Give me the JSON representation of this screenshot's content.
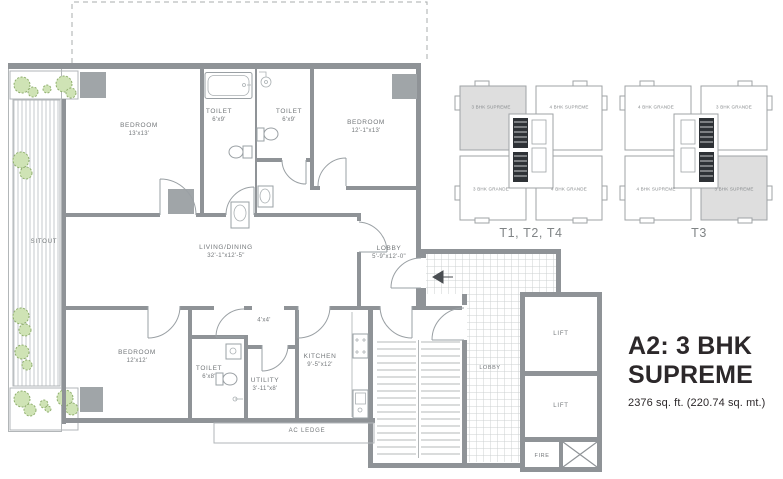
{
  "title": {
    "line1": "A2: 3 BHK",
    "line2": "SUPREME",
    "area": "2376 sq. ft. (220.74 sq. mt.)"
  },
  "plan": {
    "rooms": {
      "bedroom1": {
        "name": "BEDROOM",
        "dims": "13'x13'"
      },
      "toilet1": {
        "name": "TOILET",
        "dims": "6'x9'"
      },
      "toilet2": {
        "name": "TOILET",
        "dims": "6'x9'"
      },
      "bedroom2": {
        "name": "BEDROOM",
        "dims": "12'-1\"x13'"
      },
      "living": {
        "name": "LIVING/DINING",
        "dims": "32'-1\"x12'-5\""
      },
      "lobby": {
        "name": "LOBBY",
        "dims": "5'-9\"x12'-0\""
      },
      "bedroom3": {
        "name": "BEDROOM",
        "dims": "12'x12'"
      },
      "toilet3": {
        "name": "TOILET",
        "dims": "6'x8'"
      },
      "utility": {
        "name": "UTILITY",
        "dims": "3'-11\"x8'"
      },
      "kitchen": {
        "name": "KITCHEN",
        "dims": "9'-5\"x12'"
      },
      "passage": {
        "dims": "4'x4'"
      }
    },
    "areas": {
      "sitout": "SITOUT",
      "ac_ledge": "AC LEDGE",
      "core_lobby": "LOBBY",
      "lift": "LIFT",
      "fire": "FIRE"
    }
  },
  "keyplans": [
    {
      "caption": "T1, T2, T4",
      "units": [
        {
          "label": "3 BHK SUPREME",
          "highlight": true
        },
        {
          "label": "4 BHK SUPREME",
          "highlight": false
        },
        {
          "label": "3 BHK GRANDE",
          "highlight": false
        },
        {
          "label": "4 BHK GRANDE",
          "highlight": false
        }
      ]
    },
    {
      "caption": "T3",
      "units": [
        {
          "label": "4 BHK GRANDE",
          "highlight": false
        },
        {
          "label": "3 BHK GRANDE",
          "highlight": false
        },
        {
          "label": "4 BHK SUPREME",
          "highlight": false
        },
        {
          "label": "3 BHK SUPREME",
          "highlight": true
        }
      ]
    }
  ],
  "colors": {
    "wall": "#8f9397",
    "line": "#b2b6b8",
    "label": "#73777a",
    "caption": "#808486",
    "title": "#2c282a",
    "highlight": "#dedede",
    "shrub": "#cfe3b5",
    "shrub_edge": "#8fae6e"
  }
}
